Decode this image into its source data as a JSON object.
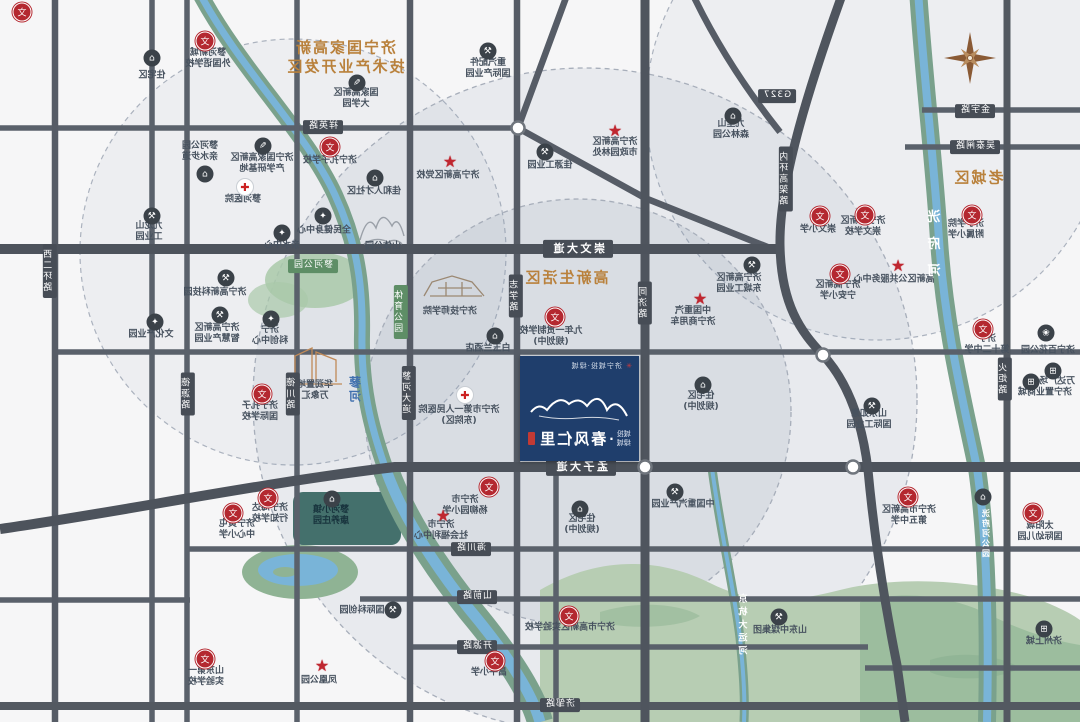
{
  "map_title": "济宁春风仁里项目区位示意图",
  "note": "image is horizontally mirrored; all text rendered flipped",
  "colors": {
    "zone_text": "#b9813c",
    "road": "#565c66",
    "river_bank": "#7aa18c",
    "river_water": "#79b4d8",
    "project_box": "#1f3e6c",
    "school_icon": "#b42830",
    "badge": "#474d56",
    "badge_green": "#5e8e66"
  },
  "project": {
    "name": "春风仁里",
    "prefix_top": "城投",
    "prefix_bottom": "绿城",
    "brand_line": "济宁城投·绿城",
    "parcel_note": "项目地块"
  },
  "zones": [
    {
      "lines": [
        "济宁国家高新",
        "技术产业开发区"
      ],
      "x": 345,
      "y": 57,
      "fs": 15
    },
    {
      "lines": [
        "高新生活区"
      ],
      "x": 566,
      "y": 278,
      "fs": 15
    },
    {
      "lines": [
        "老城区"
      ],
      "x": 978,
      "y": 178,
      "fs": 15
    }
  ],
  "badges": [
    {
      "t": "崇文大道",
      "x": 578,
      "y": 249,
      "o": "h",
      "big": true
    },
    {
      "t": "孟子大道",
      "x": 581,
      "y": 467,
      "o": "h",
      "big": true
    },
    {
      "t": "金宇路",
      "x": 975,
      "y": 111,
      "o": "h"
    },
    {
      "t": "吴泰闸路",
      "x": 975,
      "y": 147,
      "o": "h"
    },
    {
      "t": "G327",
      "x": 777,
      "y": 96,
      "o": "h"
    },
    {
      "t": "祥英路",
      "x": 323,
      "y": 127,
      "o": "h"
    },
    {
      "t": "海川路",
      "x": 471,
      "y": 549,
      "o": "h"
    },
    {
      "t": "山前路",
      "x": 477,
      "y": 597,
      "o": "h"
    },
    {
      "t": "开源路",
      "x": 477,
      "y": 647,
      "o": "h"
    },
    {
      "t": "济邹路",
      "x": 560,
      "y": 705,
      "o": "h"
    },
    {
      "t": "蓼河公园",
      "x": 313,
      "y": 266,
      "o": "h",
      "g": true
    },
    {
      "t": "体育公园",
      "x": 401,
      "y": 312,
      "o": "v",
      "g": true
    },
    {
      "t": "同济路",
      "x": 645,
      "y": 303,
      "o": "v"
    },
    {
      "t": "志学路",
      "x": 516,
      "y": 296,
      "o": "v"
    },
    {
      "t": "蓼河大道",
      "x": 409,
      "y": 393,
      "o": "v"
    },
    {
      "t": "德源路",
      "x": 188,
      "y": 394,
      "o": "v"
    },
    {
      "t": "德川路",
      "x": 293,
      "y": 394,
      "o": "v"
    },
    {
      "t": "火炬路",
      "x": 1005,
      "y": 379,
      "o": "v"
    },
    {
      "t": "西二环路",
      "x": 50,
      "y": 271,
      "o": "v"
    },
    {
      "t": "内环高架路",
      "x": 786,
      "y": 179,
      "o": "v"
    }
  ],
  "river_labels": [
    {
      "t": "洸府河",
      "x": 936,
      "y": 250,
      "fs": 13,
      "sp": 14,
      "c": "white"
    },
    {
      "t": "洸府河公园",
      "x": 986,
      "y": 534,
      "fs": 8,
      "sp": 2,
      "c": "white"
    },
    {
      "t": "京杭大运河",
      "x": 744,
      "y": 626,
      "fs": 9,
      "sp": 4,
      "c": "white"
    },
    {
      "t": "蓼河",
      "x": 355,
      "y": 390,
      "fs": 12,
      "sp": 2,
      "c": "blue"
    }
  ],
  "markers": [
    {
      "k": "school",
      "x": 205,
      "y": 41,
      "lx": 208,
      "ly": 59,
      "ls": [
        "蓼河新城",
        "外国语学校"
      ]
    },
    {
      "k": "school",
      "x": 330,
      "y": 147,
      "lx": 330,
      "ly": 161,
      "ls": [
        "济宁孔子学校"
      ]
    },
    {
      "k": "dark",
      "g": "✎",
      "x": 263,
      "y": 146,
      "lx": 262,
      "ly": 164,
      "ls": [
        "济宁国家高新区",
        "产学研基地"
      ]
    },
    {
      "k": "hosp",
      "x": 245,
      "y": 187,
      "lx": 243,
      "ly": 200,
      "ls": [
        "蓼河医院"
      ]
    },
    {
      "k": "dark",
      "g": "⌂",
      "x": 205,
      "y": 174,
      "lx": 200,
      "ly": 152,
      "ls": [
        "蓼河公园",
        "亲水步道"
      ]
    },
    {
      "k": "dark",
      "g": "⌂",
      "x": 152,
      "y": 58,
      "lx": 152,
      "ly": 76,
      "ls": [
        "住宅区"
      ]
    },
    {
      "k": "dark",
      "g": "✎",
      "x": 357,
      "y": 83,
      "lx": 356,
      "ly": 99,
      "ls": [
        "国家高新区",
        "大学园"
      ]
    },
    {
      "k": "star",
      "x": 450,
      "y": 162,
      "lx": 448,
      "ly": 176,
      "ls": [
        "济宁高新区党校"
      ]
    },
    {
      "k": "dark",
      "g": "⚒",
      "x": 488,
      "y": 51,
      "lx": 488,
      "ly": 69,
      "ls": [
        "重汽配件",
        "国际产业园"
      ]
    },
    {
      "k": "dark",
      "g": "⚒",
      "x": 545,
      "y": 152,
      "lx": 550,
      "ly": 166,
      "ls": [
        "佳源工业园"
      ]
    },
    {
      "k": "star",
      "x": 615,
      "y": 131,
      "lx": 615,
      "ly": 148,
      "ls": [
        "济宁高新区",
        "市政园林处"
      ]
    },
    {
      "k": "dark",
      "g": "⌂",
      "x": 733,
      "y": 116,
      "lx": 731,
      "ly": 130,
      "ls": [
        "九里山",
        "森林公园"
      ]
    },
    {
      "k": "school",
      "x": 820,
      "y": 216,
      "lx": 818,
      "ly": 230,
      "ls": [
        "崇文小学"
      ]
    },
    {
      "k": "school",
      "x": 865,
      "y": 215,
      "lx": 863,
      "ly": 227,
      "ls": [
        "济宁高新区",
        "崇文学校"
      ]
    },
    {
      "k": "school",
      "x": 972,
      "y": 215,
      "lx": 966,
      "ly": 230,
      "ls": [
        "济宁学院",
        "附属小学"
      ]
    },
    {
      "k": "star",
      "x": 898,
      "y": 266,
      "lx": 894,
      "ly": 280,
      "ls": [
        "高新区公共服务中心"
      ]
    },
    {
      "k": "dark",
      "g": "⚒",
      "x": 752,
      "y": 265,
      "lx": 739,
      "ly": 284,
      "ls": [
        "济宁高新区",
        "东城工业园"
      ]
    },
    {
      "k": "school",
      "x": 840,
      "y": 274,
      "lx": 838,
      "ly": 291,
      "ls": [
        "济宁高新区",
        "宁安小学"
      ]
    },
    {
      "k": "school",
      "x": 983,
      "y": 329,
      "lx": 987,
      "ly": 345,
      "ls": [
        "济宁",
        "第十二中学"
      ]
    },
    {
      "k": "dark",
      "g": "❀",
      "x": 1046,
      "y": 333,
      "lx": 1048,
      "ly": 351,
      "ls": [
        "济宁百花公园"
      ]
    },
    {
      "k": "dark",
      "g": "⊞",
      "x": 1053,
      "y": 371,
      "lx": 1057,
      "ly": 382,
      "ls": [
        "万达广场"
      ]
    },
    {
      "k": "dark",
      "g": "⊞",
      "x": 1031,
      "y": 382,
      "lx": 1045,
      "ly": 393,
      "ls": [
        "济宁置业商城"
      ]
    },
    {
      "k": "dark",
      "g": "⚒",
      "x": 872,
      "y": 406,
      "lx": 869,
      "ly": 420,
      "ls": [
        "山东如意",
        "国际工业园"
      ]
    },
    {
      "k": "star",
      "x": 700,
      "y": 299,
      "lx": 693,
      "ly": 317,
      "ls": [
        "中国重汽",
        "济宁商用车"
      ]
    },
    {
      "k": "dark",
      "g": "⚒",
      "x": 675,
      "y": 492,
      "lx": 683,
      "ly": 505,
      "ls": [
        "中国重汽产业园"
      ]
    },
    {
      "k": "dark",
      "g": "⚒",
      "x": 226,
      "y": 278,
      "lx": 215,
      "ly": 293,
      "ls": [
        "济宁高新科技园"
      ]
    },
    {
      "k": "dark",
      "g": "✦",
      "x": 155,
      "y": 322,
      "lx": 151,
      "ly": 335,
      "ls": [
        "文化产业园"
      ]
    },
    {
      "k": "dark",
      "g": "⚒",
      "x": 220,
      "y": 315,
      "lx": 217,
      "ly": 334,
      "ls": [
        "济宁高新区",
        "智慧产业园"
      ]
    },
    {
      "k": "dark",
      "g": "✦",
      "x": 271,
      "y": 319,
      "lx": 270,
      "ly": 336,
      "ls": [
        "济宁",
        "科创中心"
      ]
    },
    {
      "k": "school",
      "x": 262,
      "y": 394,
      "lx": 260,
      "ly": 412,
      "ls": [
        "济宁孔子",
        "国际学校"
      ]
    },
    {
      "k": "none",
      "lx": 315,
      "ly": 391,
      "ls": [
        "华润置地",
        "万象汇"
      ]
    },
    {
      "k": "school",
      "x": 555,
      "y": 317,
      "lx": 551,
      "ly": 337,
      "ls": [
        "九年一贯制学校",
        "(规划中)"
      ]
    },
    {
      "k": "dark",
      "g": "⌂",
      "x": 495,
      "y": 336,
      "lx": 488,
      "ly": 349,
      "ls": [
        "白玉兰酒店"
      ]
    },
    {
      "k": "hosp",
      "x": 465,
      "y": 395,
      "lx": 459,
      "ly": 416,
      "ls": [
        "济宁市第一人民医院",
        "(东院区)"
      ]
    },
    {
      "k": "dark",
      "g": "⌂",
      "x": 703,
      "y": 385,
      "lx": 701,
      "ly": 402,
      "ls": [
        "住宅区",
        "(规划中)"
      ]
    },
    {
      "k": "none",
      "lx": 450,
      "ly": 312,
      "ls": [
        "济宁技师学院"
      ]
    },
    {
      "k": "star",
      "x": 443,
      "y": 516,
      "lx": 441,
      "ly": 531,
      "ls": [
        "济宁市",
        "社会福利中心"
      ]
    },
    {
      "k": "school",
      "x": 268,
      "y": 498,
      "lx": 270,
      "ly": 514,
      "ls": [
        "济宁海达",
        "行知学校"
      ]
    },
    {
      "k": "school",
      "x": 233,
      "y": 513,
      "lx": 237,
      "ly": 530,
      "ls": [
        "济宁黄屯",
        "中心小学"
      ]
    },
    {
      "k": "dark",
      "g": "⌂",
      "x": 332,
      "y": 499,
      "lx": 331,
      "ly": 516,
      "ls": [
        "蓼河小镇",
        "康养庄园"
      ],
      "teal": true
    },
    {
      "k": "dark",
      "g": "⌂",
      "x": 580,
      "y": 509,
      "lx": 582,
      "ly": 525,
      "ls": [
        "住宅区",
        "(规划中)"
      ]
    },
    {
      "k": "school",
      "x": 489,
      "y": 487,
      "lx": 465,
      "ly": 506,
      "ls": [
        "济宁市",
        "杨柳园小学"
      ]
    },
    {
      "k": "school",
      "x": 569,
      "y": 616,
      "lx": 570,
      "ly": 628,
      "ls": [
        "济宁市高新区实验学校"
      ]
    },
    {
      "k": "school",
      "x": 495,
      "y": 661,
      "lx": 489,
      "ly": 673,
      "ls": [
        "昌平小学"
      ]
    },
    {
      "k": "dark",
      "g": "⚒",
      "x": 393,
      "y": 610,
      "lx": 362,
      "ly": 611,
      "ls": [
        "国际科创园"
      ]
    },
    {
      "k": "school",
      "x": 205,
      "y": 659,
      "lx": 206,
      "ly": 677,
      "ls": [
        "山东第一",
        "实验学校"
      ]
    },
    {
      "k": "star",
      "x": 322,
      "y": 666,
      "lx": 319,
      "ly": 681,
      "ls": [
        "凤凰公园"
      ]
    },
    {
      "k": "school",
      "x": 908,
      "y": 497,
      "lx": 909,
      "ly": 516,
      "ls": [
        "济宁市高新区",
        "第五中学"
      ]
    },
    {
      "k": "school",
      "x": 1033,
      "y": 513,
      "lx": 1040,
      "ly": 532,
      "ls": [
        "太阳城",
        "国际幼儿园"
      ]
    },
    {
      "k": "dark",
      "g": "⚒",
      "x": 779,
      "y": 617,
      "lx": 780,
      "ly": 631,
      "ls": [
        "山东中煤集团"
      ]
    },
    {
      "k": "dark",
      "g": "⊞",
      "x": 1044,
      "y": 629,
      "lx": 1044,
      "ly": 642,
      "ls": [
        "济州上城"
      ]
    },
    {
      "k": "dark",
      "g": "⌂",
      "x": 983,
      "y": 497
    },
    {
      "k": "school",
      "x": 22,
      "y": 12
    },
    {
      "k": "dark",
      "g": "✦",
      "x": 323,
      "y": 216,
      "lx": 324,
      "ly": 231,
      "ls": [
        "全民健身中心"
      ]
    },
    {
      "k": "none",
      "lx": 383,
      "ly": 247,
      "ls": [
        "山体公园"
      ]
    },
    {
      "k": "dark",
      "g": "⚒",
      "x": 152,
      "y": 216,
      "lx": 149,
      "ly": 232,
      "ls": [
        "九龙山",
        "工业园"
      ]
    },
    {
      "k": "dark",
      "g": "✦",
      "x": 282,
      "y": 233,
      "lx": 282,
      "ly": 246,
      "ls": [
        "亲水中心"
      ]
    },
    {
      "k": "dark",
      "g": "⌂",
      "x": 375,
      "y": 178,
      "lx": 374,
      "ly": 192,
      "ls": [
        "佳和人才社区"
      ]
    }
  ],
  "compass": {
    "type": "eight-point-star",
    "x": 968,
    "y": 57
  }
}
